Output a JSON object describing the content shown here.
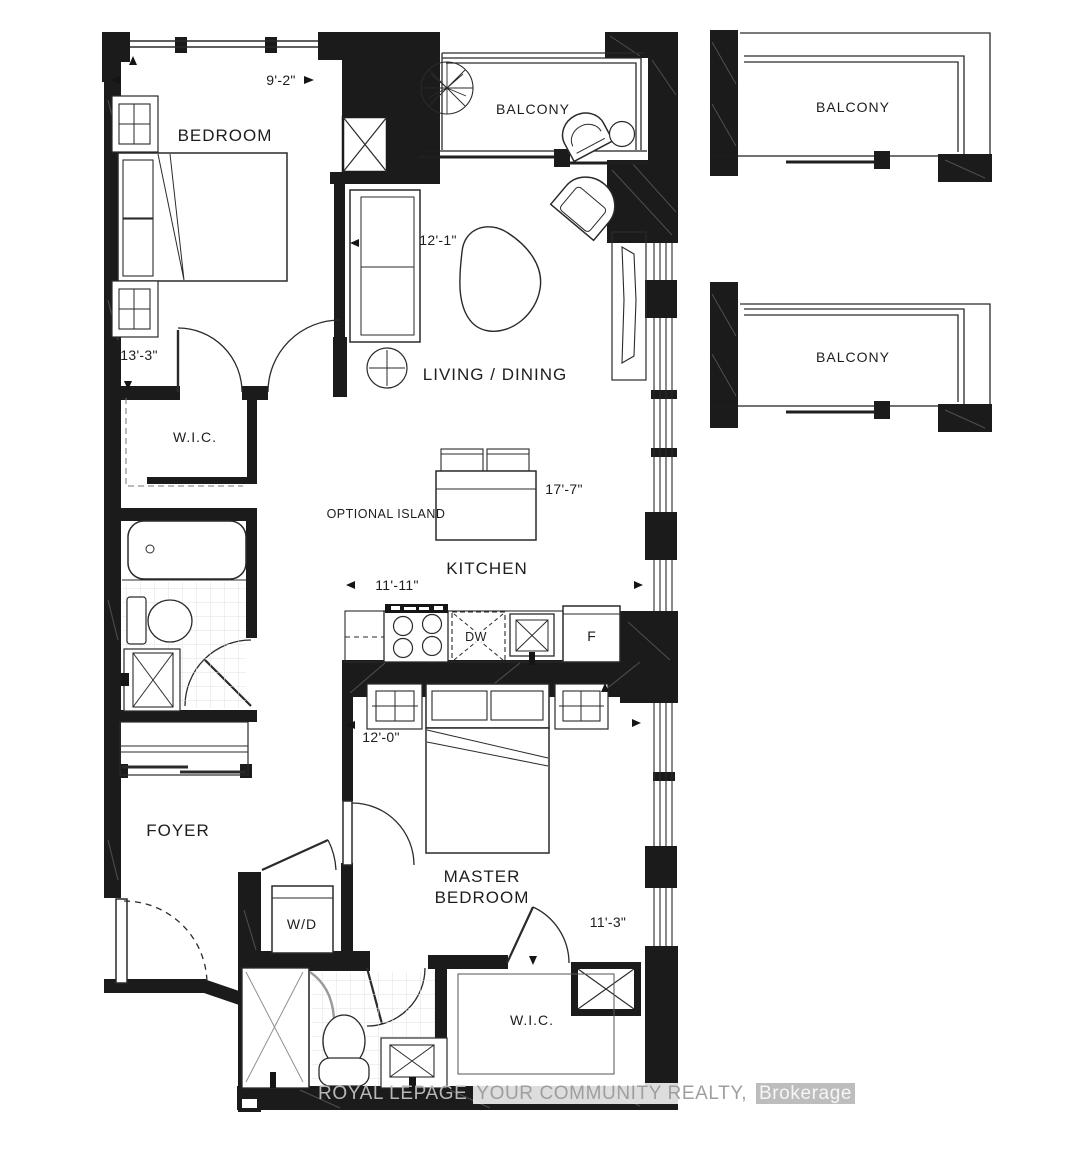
{
  "labels": {
    "bedroom": "BEDROOM",
    "balcony_top": "BALCONY",
    "balcony_right_1": "BALCONY",
    "balcony_right_2": "BALCONY",
    "living_dining": "LIVING / DINING",
    "wic_hall": "W.I.C.",
    "wic_master": "W.I.C.",
    "kitchen": "KITCHEN",
    "optional_island": "OPTIONAL ISLAND",
    "foyer": "FOYER",
    "master_bedroom": "MASTER BEDROOM",
    "washer_dryer": "W/D",
    "dishwasher": "DW",
    "fridge": "F"
  },
  "dimensions": {
    "bedroom_width": "9'-2\"",
    "bedroom_depth": "13'-3\"",
    "living_width": "12'-1\"",
    "unit_length": "17'-7\"",
    "kitchen_width": "11'-11\"",
    "master_width": "12'-0\"",
    "master_depth": "11'-3\""
  },
  "watermark": {
    "brand": "ROYAL LEPAGE",
    "middle": "YOUR COMMUNITY REALTY,",
    "suffix": "Brokerage"
  },
  "colors": {
    "wall": "#1b1b1b",
    "line": "#2a2a2a",
    "tile": "#e0e0e0",
    "watermark_gray": "#b7b7b7"
  }
}
